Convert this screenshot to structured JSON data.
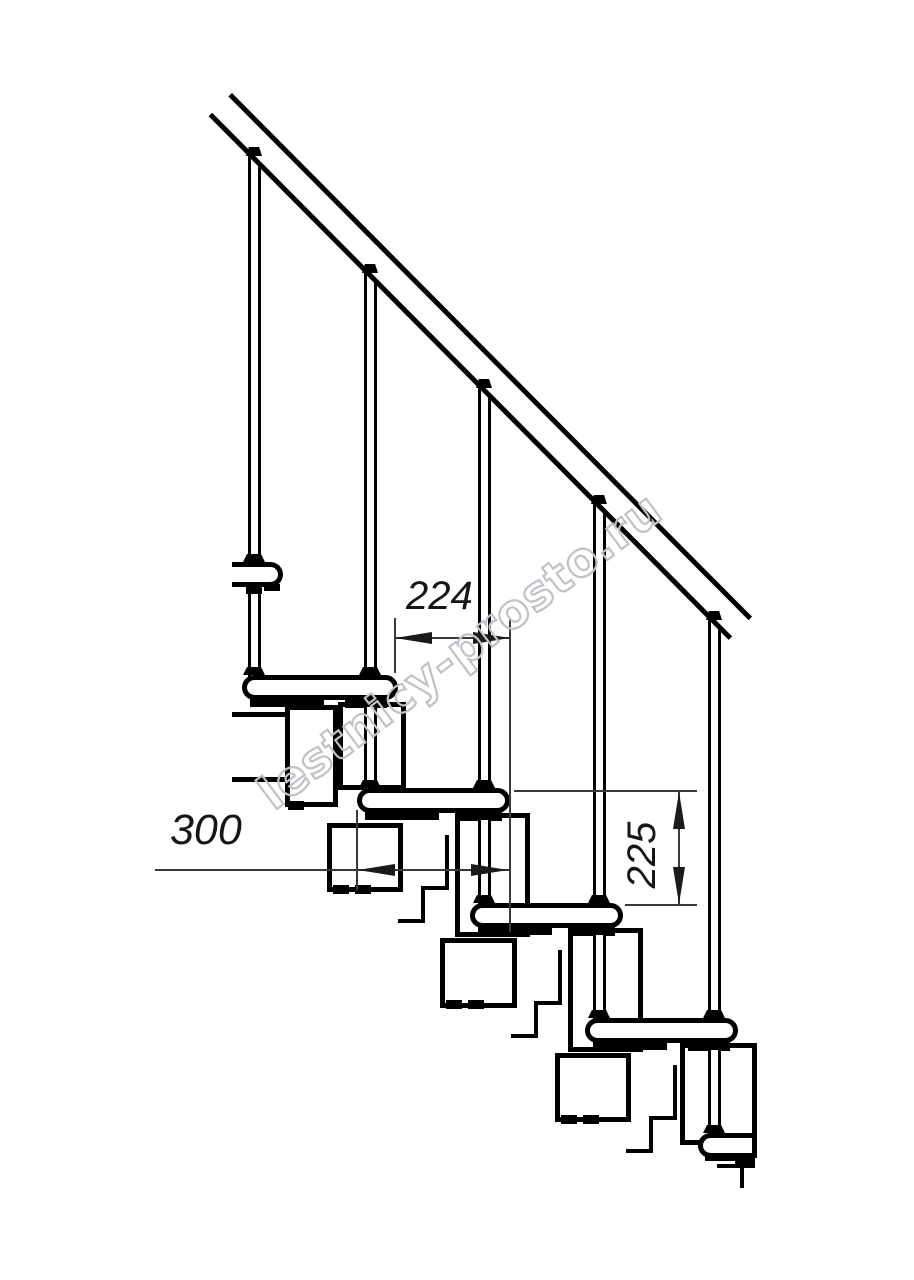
{
  "drawing": {
    "title": "Modular staircase side-view technical drawing",
    "watermark": "lestnicy-prosto.ru",
    "dimensions": {
      "step_going": "224",
      "tread_depth": "300",
      "riser_height": "225"
    },
    "colors": {
      "line": "#000000",
      "dim_line": "#3a3a3a",
      "dim_text": "#161616",
      "watermark_outline": "#bfc3c7",
      "background": "#ffffff"
    }
  }
}
